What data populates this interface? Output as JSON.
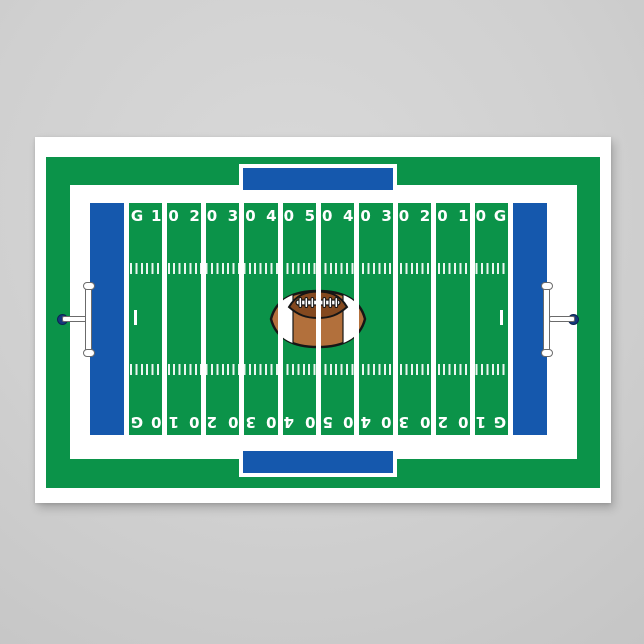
{
  "colors": {
    "wall": "#d0d0d0",
    "poster": "#ffffff",
    "green": "#0b9349",
    "blue": "#1558ad",
    "navy": "#16387c",
    "line": "#ffffff",
    "ball-brown": "#b2703c",
    "ball-dark": "#84491f",
    "ball-outline": "#161616",
    "lace": "#ffffff"
  },
  "field": {
    "yard_labels_top": [
      "G",
      "10",
      "20",
      "30",
      "40",
      "50",
      "40",
      "30",
      "20",
      "10",
      "G"
    ],
    "yard_labels_bottom": [
      "G",
      "10",
      "20",
      "30",
      "40",
      "50",
      "40",
      "30",
      "20",
      "10",
      "G"
    ]
  },
  "icons": {
    "football": "football-icon",
    "goal_post_left": "goal-post-left-icon",
    "goal_post_right": "goal-post-right-icon"
  }
}
